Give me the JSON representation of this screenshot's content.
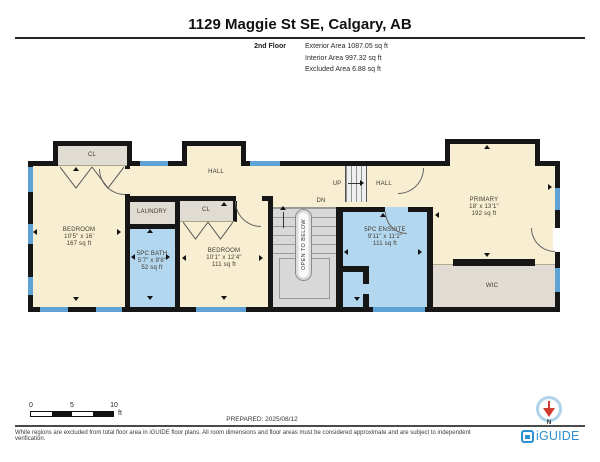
{
  "header": {
    "title": "1129 Maggie St SE, Calgary, AB",
    "floor_label": "2nd Floor",
    "areas": [
      "Exterior Area 1087.05 sq ft",
      "Interior Area 997.32 sq ft",
      "Excluded Area 6.88 sq ft"
    ]
  },
  "plan": {
    "rooms": {
      "bedroom1": {
        "name": "BEDROOM",
        "dims": "10'5\" x 16'",
        "area": "167 sq ft"
      },
      "bedroom2": {
        "name": "BEDROOM",
        "dims": "10'1\" x 12'4\"",
        "area": "111 sq ft"
      },
      "bath": {
        "name": "5PC BATH",
        "dims": "5'7\" x 9'8\"",
        "area": "52 sq ft"
      },
      "ensuite": {
        "name": "5PC ENSUITE",
        "dims": "9'11\" x 11'2\"",
        "area": "111 sq ft"
      },
      "primary": {
        "name": "PRIMARY",
        "dims": "18' x 13'1\"",
        "area": "192 sq ft"
      },
      "laundry": {
        "name": "LAUNDRY"
      },
      "wic": {
        "name": "WIC"
      },
      "closet1": {
        "name": "CL"
      },
      "closet2": {
        "name": "CL"
      },
      "hall1": {
        "name": "HALL"
      },
      "hall2": {
        "name": "HALL"
      },
      "up": "UP",
      "dn": "DN",
      "open_below": "OPEN TO BELOW"
    },
    "colors": {
      "wall": "#161616",
      "dry_room": "#f8eed2",
      "wet_room": "#b3d7ee",
      "utility_room": "#e0dcd3",
      "stairs": "#d8d8d8",
      "window": "#5ea3d4"
    }
  },
  "footer": {
    "scale": {
      "ticks": [
        "0",
        "5",
        "10"
      ],
      "unit": "ft"
    },
    "prepared": "PREPARED: 2025/08/12",
    "compass_label": "N",
    "disclaimer": "White regions are excluded from total floor area in iGUIDE floor plans. All room dimensions and floor areas must be considered approximate and are subject to independent verification.",
    "brand": "iGUIDE"
  }
}
